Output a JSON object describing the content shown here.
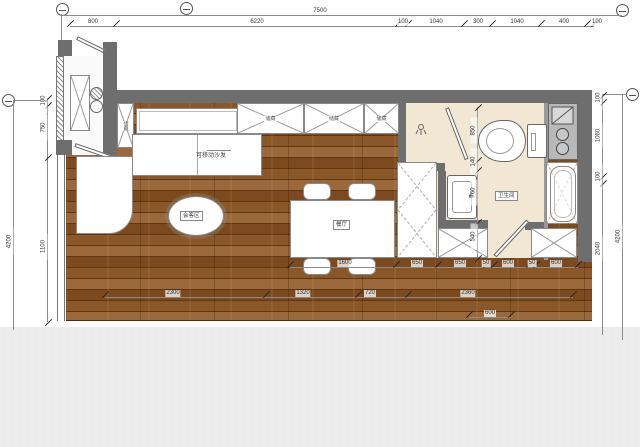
{
  "plan": {
    "rooms": {
      "meeting_area": "会客区",
      "dining": "餐厅",
      "bathroom": "卫生间",
      "sofa": "可移动沙发",
      "storage": "储藏"
    },
    "top_cabinets": [
      {
        "t": "储藏",
        "x": 237,
        "w": 67
      },
      {
        "t": "储藏",
        "x": 304,
        "w": 60
      },
      {
        "t": "储藏",
        "x": 364,
        "w": 35
      }
    ],
    "side_cabinet_label": "储藏"
  },
  "dims": {
    "total_width": "7500",
    "top_row": {
      "labels": [
        {
          "t": "800",
          "x": 23
        },
        {
          "t": "6220",
          "x": 187
        },
        {
          "t": "100",
          "x": 333
        },
        {
          "t": "1040",
          "x": 366
        },
        {
          "t": "300",
          "x": 408
        },
        {
          "t": "1040",
          "x": 447
        },
        {
          "t": "400",
          "x": 494
        },
        {
          "t": "100",
          "x": 527
        }
      ],
      "ticks": [
        {
          "x": 0
        },
        {
          "x": 46
        },
        {
          "x": 328
        },
        {
          "x": 338
        },
        {
          "x": 394
        },
        {
          "x": 422
        },
        {
          "x": 471
        },
        {
          "x": 517
        },
        {
          "x": 524
        }
      ]
    },
    "left_outer": "4200",
    "left_row": {
      "labels": [
        {
          "t": "100",
          "y": -1
        },
        {
          "t": "750",
          "y": 26
        },
        {
          "t": "1100",
          "y": 145
        }
      ],
      "ticks": [
        {
          "y": 0
        },
        {
          "y": 7
        },
        {
          "y": 59
        },
        {
          "y": 224
        }
      ]
    },
    "right_outer": "4200",
    "right_row": {
      "labels": [
        {
          "t": "100",
          "y": -1
        },
        {
          "t": "1060",
          "y": 37
        },
        {
          "t": "100",
          "y": 78
        },
        {
          "t": "2040",
          "y": 150
        }
      ],
      "ticks": [
        {
          "y": 0
        },
        {
          "y": 7
        },
        {
          "y": 81
        },
        {
          "y": 88
        }
      ]
    },
    "row_a": {
      "labels": [
        {
          "t": "1600",
          "x": 55
        },
        {
          "t": "650",
          "x": 127
        },
        {
          "t": "650",
          "x": 170
        },
        {
          "t": "50",
          "x": 196
        },
        {
          "t": "600",
          "x": 218
        },
        {
          "t": "50",
          "x": 242
        },
        {
          "t": "600",
          "x": 266
        }
      ],
      "ticks": [
        {
          "x": 0
        },
        {
          "x": 106
        },
        {
          "x": 148
        },
        {
          "x": 196
        },
        {
          "x": 204
        },
        {
          "x": 239
        },
        {
          "x": 246
        },
        {
          "x": 288
        }
      ]
    },
    "row_b": {
      "labels": [
        {
          "t": "2300",
          "x": 68
        },
        {
          "t": "1320",
          "x": 198
        },
        {
          "t": "720",
          "x": 265
        },
        {
          "t": "2360",
          "x": 363
        }
      ],
      "ticks": [
        {
          "x": 0
        },
        {
          "x": 161
        },
        {
          "x": 253
        },
        {
          "x": 303
        },
        {
          "x": 468
        }
      ]
    },
    "row_c": {
      "labels": [
        {
          "t": "600",
          "x": 21
        }
      ],
      "ticks": [
        {
          "x": 0
        },
        {
          "x": 42
        }
      ]
    },
    "bath_row": {
      "labels": [
        {
          "t": "850",
          "y": 20
        },
        {
          "t": "140",
          "y": 51
        },
        {
          "t": "760",
          "y": 82
        },
        {
          "t": "540",
          "y": 126
        }
      ],
      "ticks": [
        {
          "y": 0
        },
        {
          "y": 53
        },
        {
          "y": 63
        },
        {
          "y": 115
        },
        {
          "y": 151
        }
      ]
    }
  },
  "colors": {
    "wall": "#6e6e6e",
    "wood_dark": "#5f3512",
    "wood_mid": "#8a5728",
    "bath_floor": "#f2e7d2",
    "counter": "#b8b8b8"
  }
}
